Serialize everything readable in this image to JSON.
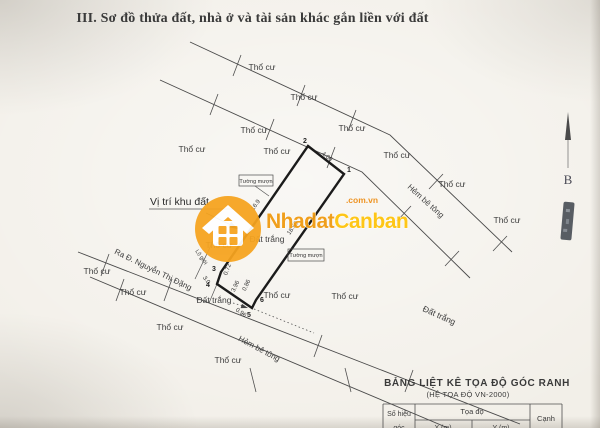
{
  "page": {
    "title": "III. Sơ đồ thửa đất, nhà ở và tài sản khác gắn liền với đất"
  },
  "compass": {
    "north_label": "B"
  },
  "watermark": {
    "brand_first": "Nhadat",
    "brand_second": "Canban",
    "brand_domain": ".com.vn",
    "accent_orange": "#f6a41f",
    "accent_yellow": "#ffc40a"
  },
  "map": {
    "land_use_label": "Thổ cư",
    "vacant_land_label": "Đất trắng",
    "alley_label": "Hẻm bê tông",
    "street_label": "Ra Đ. Nguyễn Thị Đặng",
    "road_boundary_label": "Lộ giới",
    "borrowed_wall_label": "Tường mượn",
    "location_label": "Vị trí khu đất",
    "plot": {
      "corner_1": "1",
      "corner_2": "2",
      "corner_3": "3",
      "corner_4": "4",
      "corner_5": "5",
      "corner_6": "6",
      "dim_frontage": "4.00",
      "dim_east_side": "18.50",
      "dim_west_side": "16.9",
      "dim_seg_a": "0.72",
      "dim_seg_b": "3.96",
      "dim_seg_c": "0.86",
      "dim_seg_d": "0.96",
      "dim_setback": "3.0"
    }
  },
  "coordinate_table": {
    "title": "BẢNG LIỆT KÊ TỌA ĐỘ GÓC RANH",
    "subtitle": "(HỆ TỌA ĐỘ VN-2000)",
    "col_point_id_line1": "Số hiệu",
    "col_point_id_line2": "góc",
    "col_coordinates": "Tọa độ",
    "col_x": "X (m)",
    "col_y": "Y (m)",
    "col_edge": "Cạnh"
  }
}
